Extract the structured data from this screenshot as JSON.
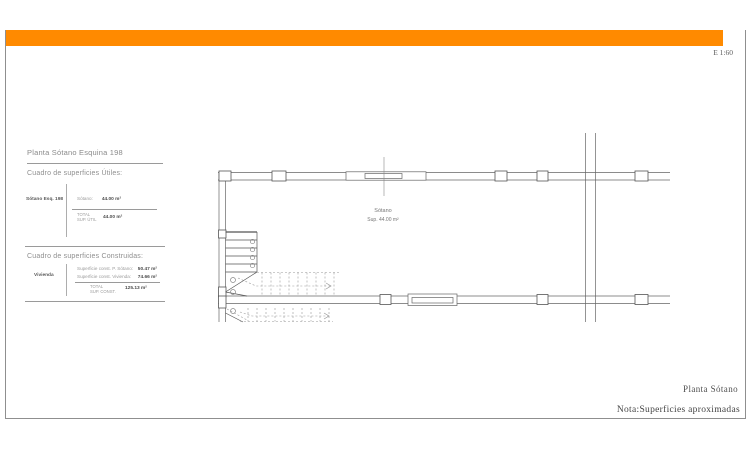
{
  "sheet": {
    "scale_label": "E 1:60",
    "accent_color": "#FF8A00"
  },
  "panel": {
    "title": "Planta Sótano Esquina 198",
    "utiles": {
      "heading": "Cuadro de superficies Útiles:",
      "row_label": "Sótano Esq. 198",
      "item_label": "Sótano:",
      "item_value": "44.00 m²",
      "total_line1": "TOTAL",
      "total_line2": "SUP. ÚTIL",
      "total_value": "44.00 m²"
    },
    "construidas": {
      "heading": "Cuadro de superficies Construidas:",
      "row_label": "Vivienda",
      "item1_label": "Superficie const. P. Sótano:",
      "item1_value": "50.47 m²",
      "item2_label": "Superficie const. Vivienda:",
      "item2_value": "74.66 m²",
      "total_line1": "TOTAL",
      "total_line2": "SUP. CONST.",
      "total_value": "125.13 m²"
    }
  },
  "plan": {
    "room_name": "Sótano",
    "room_area": "Sup. 44.00 m²"
  },
  "footer": {
    "drawing_title": "Planta Sótano",
    "note": "Nota:Superficies aproximadas"
  }
}
